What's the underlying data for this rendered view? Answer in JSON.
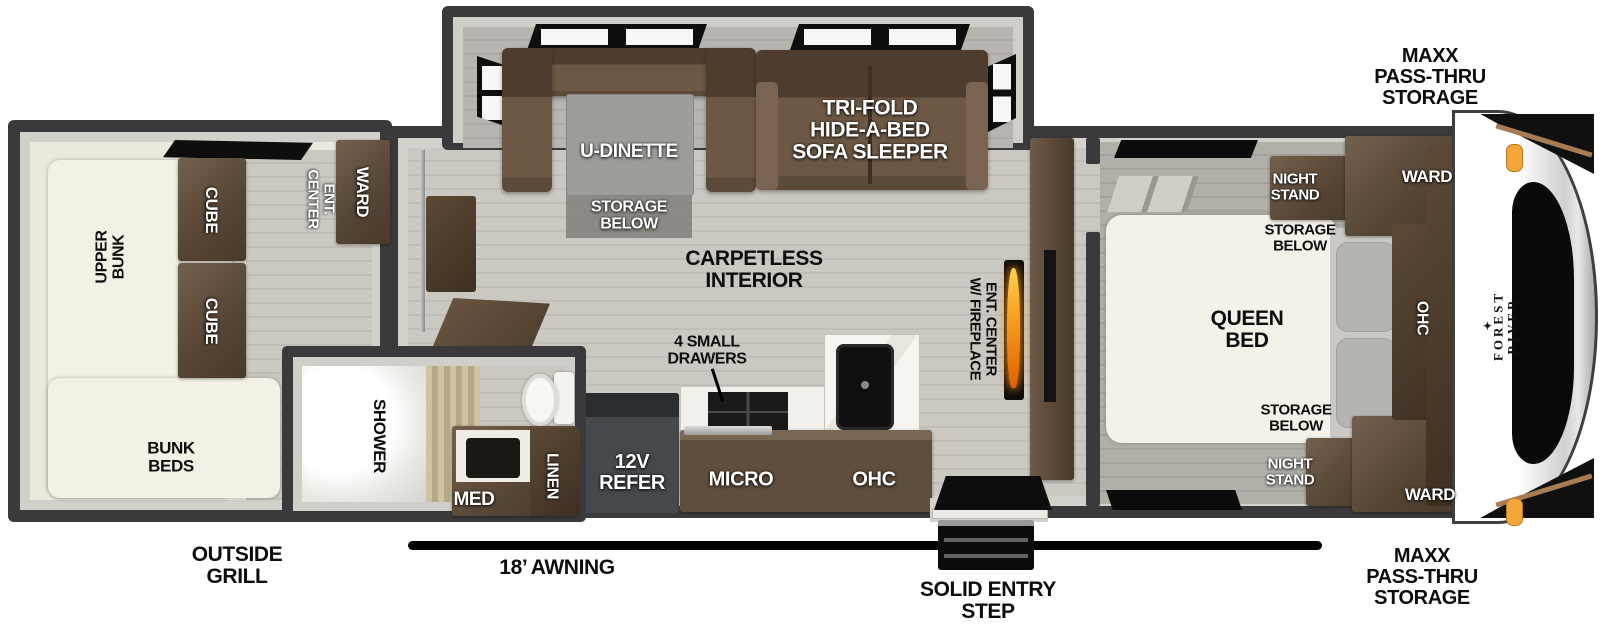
{
  "brand": {
    "name": "FOREST RIVER",
    "logo_icon": "✦"
  },
  "exterior": {
    "storage_top": "MAXX\nPASS-THRU\nSTORAGE",
    "storage_bottom": "MAXX\nPASS-THRU\nSTORAGE",
    "awning": "18’ AWNING",
    "entry_step": "SOLID ENTRY\nSTEP",
    "outside_grill": "OUTSIDE\nGRILL"
  },
  "bunk_room": {
    "upper_bunk": "UPPER\nBUNK",
    "cube_top": "CUBE",
    "cube_bottom": "CUBE",
    "ent_center": "ENT.\nCENTER",
    "ward": "WARD",
    "bunk_beds": "BUNK\nBEDS"
  },
  "bathroom": {
    "shower": "SHOWER",
    "med": "MED",
    "linen": "LINEN"
  },
  "living": {
    "u_dinette": "U-DINETTE",
    "storage_below": "STORAGE\nBELOW",
    "sofa": "TRI-FOLD\nHIDE-A-BED\nSOFA SLEEPER",
    "carpetless": "CARPETLESS\nINTERIOR",
    "ent_center_fireplace": "ENT. CENTER\nW/ FIREPLACE"
  },
  "kitchen": {
    "drawers": "4 SMALL\nDRAWERS",
    "refrigerator": "12V\nREFER",
    "microwave": "MICRO",
    "ohc": "OHC"
  },
  "bedroom": {
    "night_stand_top": "NIGHT\nSTAND",
    "storage_below_top": "STORAGE\nBELOW",
    "queen_bed": "QUEEN\nBED",
    "storage_below_bottom": "STORAGE\nBELOW",
    "night_stand_bottom": "NIGHT\nSTAND",
    "ward_top": "WARD",
    "ward_bottom": "WARD",
    "ohc": "OHC"
  },
  "palette": {
    "wall": "#3a3a3c",
    "wood_floor": "#c8c5bf",
    "furniture_brown": "#5f4c3b",
    "flame_orange": "#f59b1d",
    "marker_light": "#f2a33c"
  }
}
